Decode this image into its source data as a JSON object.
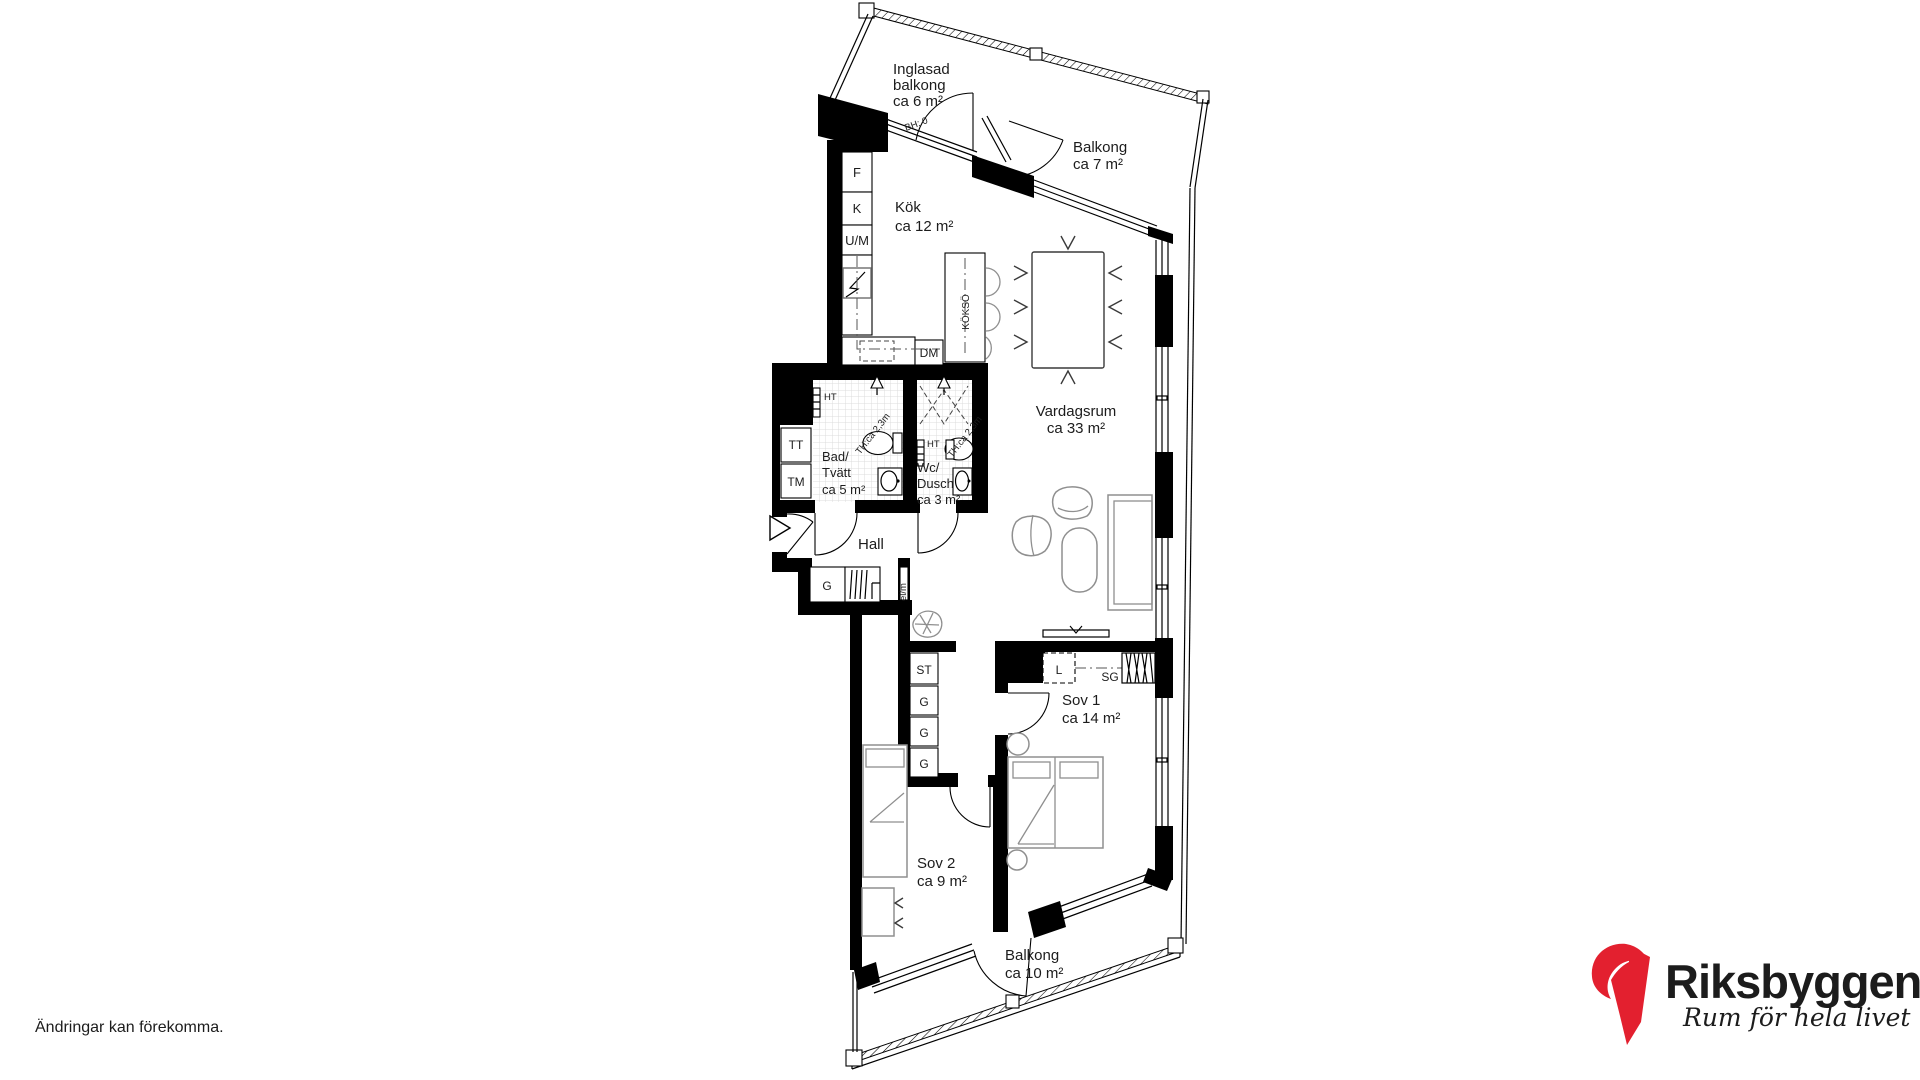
{
  "plan": {
    "rooms": {
      "inglasad_balkong": {
        "lines": [
          "Inglasad",
          "balkong",
          "ca 6 m²"
        ]
      },
      "balkong_7": {
        "lines": [
          "Balkong",
          "ca 7 m²"
        ]
      },
      "kok": {
        "lines": [
          "Kök",
          "ca 12 m²"
        ]
      },
      "vardagsrum": {
        "lines": [
          "Vardagsrum",
          "ca 33 m²"
        ]
      },
      "bad_tvatt": {
        "lines": [
          "Bad/",
          "Tvätt",
          "ca 5 m²"
        ]
      },
      "wc_dusch": {
        "lines": [
          "Wc/",
          "Dusch",
          "ca 3 m²"
        ]
      },
      "hall": {
        "lines": [
          "Hall"
        ]
      },
      "sov_1": {
        "lines": [
          "Sov 1",
          "ca 14 m²"
        ]
      },
      "sov_2": {
        "lines": [
          "Sov 2",
          "ca 9 m²"
        ]
      },
      "balkong_10": {
        "lines": [
          "Balkong",
          "ca 10 m²"
        ]
      }
    },
    "fixtures": {
      "f": "F",
      "k": "K",
      "um": "U/M",
      "dm": "DM",
      "kokso": "KÖKSÖ",
      "bh": "BH: 0",
      "ht_bad": "HT",
      "ht_wc": "HT",
      "tt": "TT",
      "tm": "TM",
      "th_bad": "TH:ca 2,3m",
      "th_wc": "TH:ca 2,3m",
      "g_hall": "G",
      "elm": "el/m",
      "st": "ST",
      "g1": "G",
      "g2": "G",
      "g3": "G",
      "l": "L",
      "sg": "SG"
    }
  },
  "footer": {
    "disclaimer": "Ändringar kan förekomma."
  },
  "logo": {
    "brand": "Riksbyggen",
    "tagline": "Rum för hela livet",
    "red": "#e3202f",
    "gray": "#9a9a9a"
  }
}
